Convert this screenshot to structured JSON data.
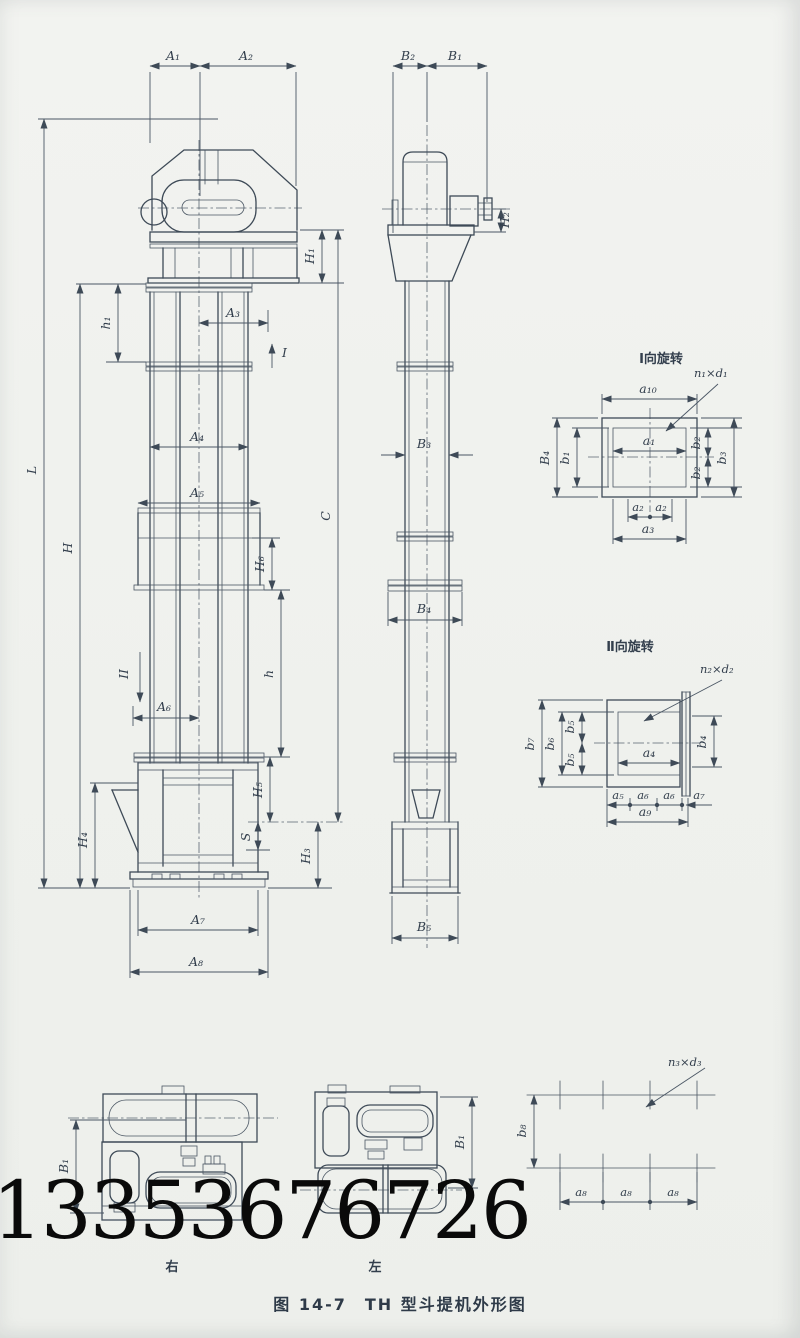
{
  "watermark": "13353676726",
  "caption": "图 14-7　TH 型斗提机外形图",
  "front_view": {
    "dims": {
      "A1": "A₁",
      "A2": "A₂",
      "A3": "A₃",
      "A4": "A₄",
      "A5": "A₅",
      "A6": "A₆",
      "A7": "A₇",
      "A8": "A₈",
      "h1": "h₁",
      "H1": "H₁",
      "H3": "H₃",
      "H4": "H₄",
      "H5": "H₅",
      "H6": "H₆",
      "S": "S",
      "L": "L",
      "H": "H",
      "h": "h",
      "C": "C",
      "view_I": "I",
      "view_II": "II"
    }
  },
  "side_view": {
    "dims": {
      "B1": "B₁",
      "B2": "B₂",
      "B3": "B₃",
      "B4": "B₄",
      "B5": "B₅",
      "H2": "H₂"
    }
  },
  "detail_I": {
    "title": "I向旋转",
    "bolt_note": "n₁×d₁",
    "dims": {
      "a10": "a₁₀",
      "a1": "a₁",
      "a2": "a₂",
      "a3": "a₃",
      "B4": "B₄",
      "b1": "b₁",
      "b2": "b₂",
      "b3": "b₃"
    }
  },
  "detail_II": {
    "title": "Ⅱ向旋转",
    "bolt_note": "n₂×d₂",
    "dims": {
      "a4": "a₄",
      "a5": "a₅",
      "a6": "a₆",
      "a7": "a₇",
      "a9": "a₉",
      "b4": "b₄",
      "b5": "b₅",
      "b6": "b₆",
      "b7": "b₇"
    }
  },
  "foot_views": {
    "right_label": "右",
    "left_label": "左",
    "dim_B1": "B₁"
  },
  "anchor_plan": {
    "bolt_note": "n₃×d₃",
    "dim_a8": "a₈",
    "dim_b8": "b₈"
  }
}
